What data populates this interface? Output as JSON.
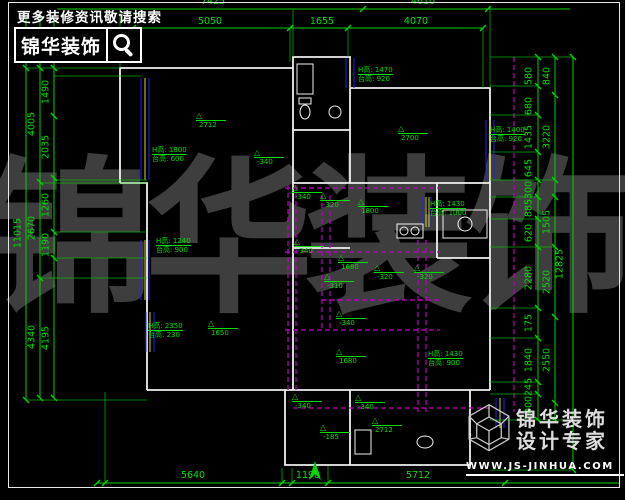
{
  "palette": {
    "background": "#000000",
    "dim_line_green": "#00d400",
    "annotation_green": "#00e000",
    "wall_white": "#f0f0f0",
    "ceiling_magenta": "#c000c0",
    "window_blue": "#2222ee",
    "window_yellow": "#d8d800",
    "watermark_gray": "#3e3e3e",
    "logo_white": "#ffffff"
  },
  "header": {
    "slogan": "更多装修资讯敬请搜索",
    "brand": "锦华装饰",
    "search_icon": "magnifier-icon"
  },
  "footer": {
    "logo_icon": "cube-wireframe-icon",
    "brand_line1": "锦华装饰",
    "brand_line2": "设计专家",
    "website": "WWW.JS-JINHUA.COM"
  },
  "watermark": {
    "characters": [
      "锦",
      "华",
      "装",
      "饰"
    ]
  },
  "dimensions": {
    "top_row_outer": [
      {
        "text": "7425",
        "x": 213,
        "y": -4
      },
      {
        "text": "4610",
        "x": 423,
        "y": -4
      }
    ],
    "top_row_inner": [
      {
        "text": "5050",
        "x": 210,
        "y": 16
      },
      {
        "text": "1655",
        "x": 322,
        "y": 16
      },
      {
        "text": "4070",
        "x": 416,
        "y": 16
      }
    ],
    "bottom_row": [
      {
        "text": "5640",
        "x": 193,
        "y": 470
      },
      {
        "text": "1198",
        "x": 308,
        "y": 470
      },
      {
        "text": "5712",
        "x": 418,
        "y": 470
      }
    ],
    "left_outer": [
      {
        "text": "11015",
        "x": 18,
        "y": 233,
        "rot": true
      }
    ],
    "left_middle": [
      {
        "text": "4005",
        "x": 32,
        "y": 124,
        "rot": true
      },
      {
        "text": "2670",
        "x": 32,
        "y": 228,
        "rot": true
      },
      {
        "text": "4340",
        "x": 32,
        "y": 337,
        "rot": true
      }
    ],
    "left_inner": [
      {
        "text": "1490",
        "x": 46,
        "y": 92,
        "rot": true
      },
      {
        "text": "2035",
        "x": 46,
        "y": 147,
        "rot": true
      },
      {
        "text": "1260",
        "x": 46,
        "y": 205,
        "rot": true
      },
      {
        "text": "1190",
        "x": 46,
        "y": 245,
        "rot": true
      },
      {
        "text": "4195",
        "x": 46,
        "y": 338,
        "rot": true
      }
    ],
    "right_inner": [
      {
        "text": "580",
        "x": 529,
        "y": 76,
        "rot": true
      },
      {
        "text": "680",
        "x": 529,
        "y": 106,
        "rot": true
      },
      {
        "text": "1435",
        "x": 529,
        "y": 137,
        "rot": true
      },
      {
        "text": "645",
        "x": 529,
        "y": 168,
        "rot": true
      },
      {
        "text": "300",
        "x": 529,
        "y": 190,
        "rot": true
      },
      {
        "text": "885",
        "x": 529,
        "y": 208,
        "rot": true
      },
      {
        "text": "620",
        "x": 529,
        "y": 233,
        "rot": true
      },
      {
        "text": "2280",
        "x": 529,
        "y": 278,
        "rot": true
      },
      {
        "text": "175",
        "x": 529,
        "y": 323,
        "rot": true
      },
      {
        "text": "1840",
        "x": 529,
        "y": 360,
        "rot": true
      },
      {
        "text": "245",
        "x": 529,
        "y": 387,
        "rot": true
      },
      {
        "text": "1000",
        "x": 529,
        "y": 408,
        "rot": true
      }
    ],
    "right_middle": [
      {
        "text": "840",
        "x": 547,
        "y": 76,
        "rot": true
      },
      {
        "text": "3220",
        "x": 547,
        "y": 137,
        "rot": true
      },
      {
        "text": "1505",
        "x": 547,
        "y": 222,
        "rot": true
      },
      {
        "text": "2520",
        "x": 547,
        "y": 282,
        "rot": true
      },
      {
        "text": "2550",
        "x": 547,
        "y": 360,
        "rot": true
      }
    ],
    "right_outer": [
      {
        "text": "12825",
        "x": 560,
        "y": 264,
        "rot": true
      }
    ]
  },
  "plan": {
    "elevation_markers": [
      {
        "text": "2712",
        "x": 196,
        "y": 120
      },
      {
        "text": "-340",
        "x": 254,
        "y": 157
      },
      {
        "text": "2700",
        "x": 398,
        "y": 133
      },
      {
        "text": "-340",
        "x": 292,
        "y": 192
      },
      {
        "text": "-320",
        "x": 320,
        "y": 200
      },
      {
        "text": "1800",
        "x": 358,
        "y": 206
      },
      {
        "text": "-340",
        "x": 294,
        "y": 246
      },
      {
        "text": "1680",
        "x": 338,
        "y": 262
      },
      {
        "text": "-320",
        "x": 374,
        "y": 272
      },
      {
        "text": "-320",
        "x": 414,
        "y": 272
      },
      {
        "text": "-310",
        "x": 324,
        "y": 281
      },
      {
        "text": "-340",
        "x": 336,
        "y": 318
      },
      {
        "text": "1650",
        "x": 208,
        "y": 328
      },
      {
        "text": "1680",
        "x": 336,
        "y": 356
      },
      {
        "text": "-340",
        "x": 292,
        "y": 401
      },
      {
        "text": "-340",
        "x": 355,
        "y": 402
      },
      {
        "text": "2712",
        "x": 372,
        "y": 425
      },
      {
        "text": "-185",
        "x": 320,
        "y": 432
      }
    ],
    "window_labels": [
      {
        "line1": "H高: 1800",
        "line2": "台高: 600",
        "x": 152,
        "y": 146
      },
      {
        "line1": "H高: 1470",
        "line2": "台高: 920",
        "x": 358,
        "y": 66
      },
      {
        "line1": "H高: 1400",
        "line2": "台高: 920",
        "x": 490,
        "y": 126
      },
      {
        "line1": "H高: 1240",
        "line2": "台高: 900",
        "x": 156,
        "y": 237
      },
      {
        "line1": "H高: 2350",
        "line2": "台高: 230",
        "x": 148,
        "y": 322
      },
      {
        "line1": "H高: 1430",
        "line2": "台高: 1000",
        "x": 430,
        "y": 200
      },
      {
        "line1": "H高: 1430",
        "line2": "台高: 900",
        "x": 428,
        "y": 350
      }
    ]
  }
}
